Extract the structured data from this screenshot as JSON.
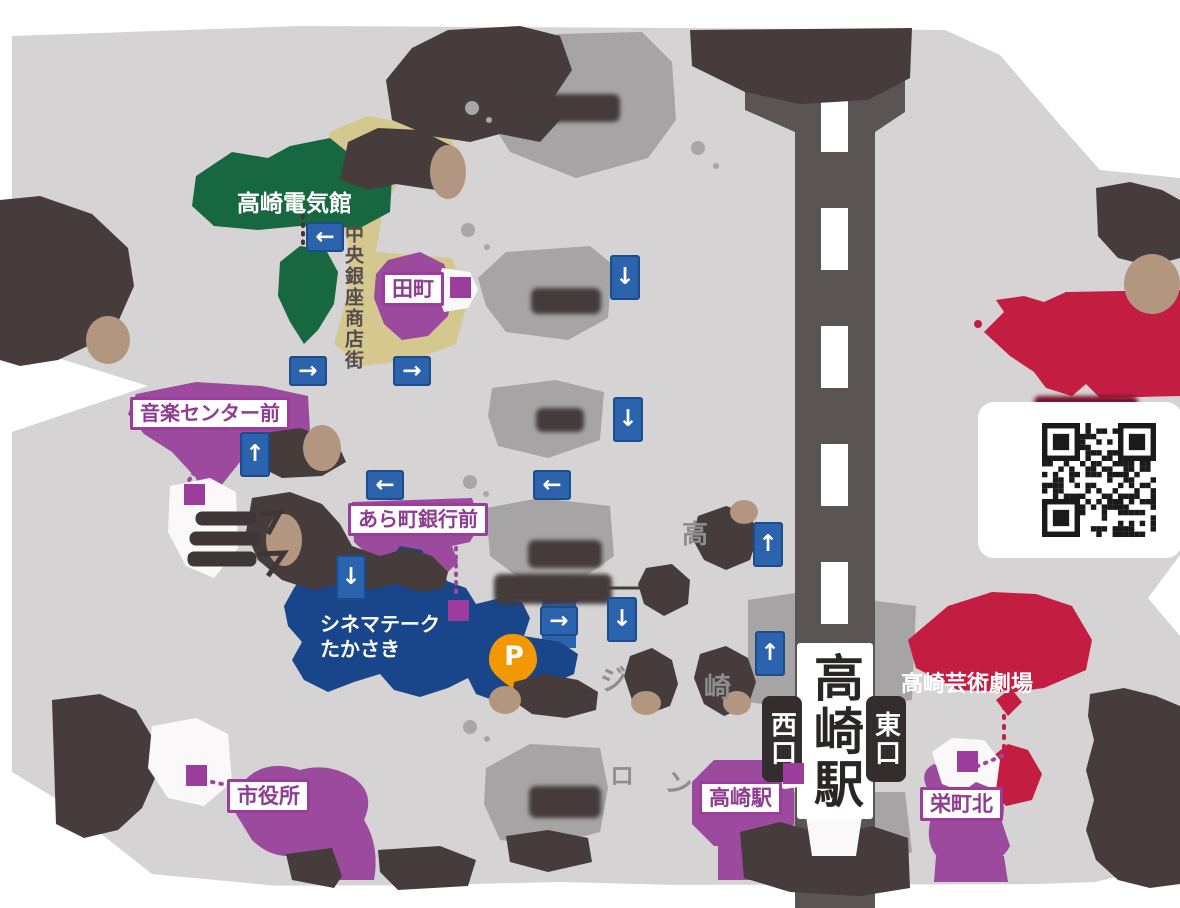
{
  "labels": {
    "denkikan": "高崎電気館",
    "chuo_ginza_shotengai": "中央銀座商店街",
    "cinematheque_line1": "シネマテーク",
    "cinematheque_line2": "たかさき",
    "geijutsu_gekijo": "高崎芸術劇場",
    "station_name": "高崎駅",
    "west_exit": "西口",
    "east_exit": "東口",
    "parking_mark": "P"
  },
  "bus_stops": {
    "tamachi": "田町",
    "ongaku_center_mae": "音楽センター前",
    "aramachi_ginko_mae": "あら町銀行前",
    "shiyakusho": "市役所",
    "takasaki_eki": "高崎駅",
    "sakaecho_kita": "栄町北"
  },
  "partial_texts": {
    "fragment_taka": "高",
    "fragment_ji": "ジ",
    "fragment_saki": "崎",
    "fragment_ro": "ロ",
    "fragment_n": "ン"
  },
  "arrows": [
    {
      "dir": "left",
      "glyph": "←",
      "x": 306,
      "y": 222
    },
    {
      "dir": "right",
      "glyph": "→",
      "x": 289,
      "y": 356
    },
    {
      "dir": "right",
      "glyph": "→",
      "x": 393,
      "y": 356
    },
    {
      "dir": "down",
      "glyph": "↓",
      "x": 610,
      "y": 255
    },
    {
      "dir": "down",
      "glyph": "↓",
      "x": 613,
      "y": 397
    },
    {
      "dir": "up",
      "glyph": "↑",
      "x": 240,
      "y": 432
    },
    {
      "dir": "left",
      "glyph": "←",
      "x": 366,
      "y": 470
    },
    {
      "dir": "left",
      "glyph": "←",
      "x": 533,
      "y": 470
    },
    {
      "dir": "down",
      "glyph": "↓",
      "x": 336,
      "y": 555
    },
    {
      "dir": "up",
      "glyph": "↑",
      "x": 753,
      "y": 522
    },
    {
      "dir": "right",
      "glyph": "→",
      "x": 540,
      "y": 606
    },
    {
      "dir": "down",
      "glyph": "↓",
      "x": 607,
      "y": 597
    },
    {
      "dir": "up",
      "glyph": "↑",
      "x": 755,
      "y": 631
    }
  ],
  "markers": [
    {
      "x": 450,
      "y": 277
    },
    {
      "x": 184,
      "y": 484
    },
    {
      "x": 448,
      "y": 600
    },
    {
      "x": 186,
      "y": 765
    },
    {
      "x": 783,
      "y": 763
    },
    {
      "x": 957,
      "y": 751
    }
  ],
  "icons": {
    "parking": "parking-pin-icon",
    "qr": "qr-code",
    "bus_marker": "bus-stop-marker",
    "route_arrow": "route-arrow-icon"
  },
  "colors": {
    "map_bg": "#d5d3d3",
    "road_gray": "#a6a4a4",
    "road_khaki": "#d4c88f",
    "rail_dark": "#5b5454",
    "tree_dark": "#463c3c",
    "tree_tan": "#b3967f",
    "green": "#176840",
    "purple": "#9c4a9d",
    "purple_text": "#8e3d92",
    "navy_building": "#19468a",
    "route_blue": "#2b63ac",
    "red": "#c31d41",
    "orange": "#f39800"
  }
}
